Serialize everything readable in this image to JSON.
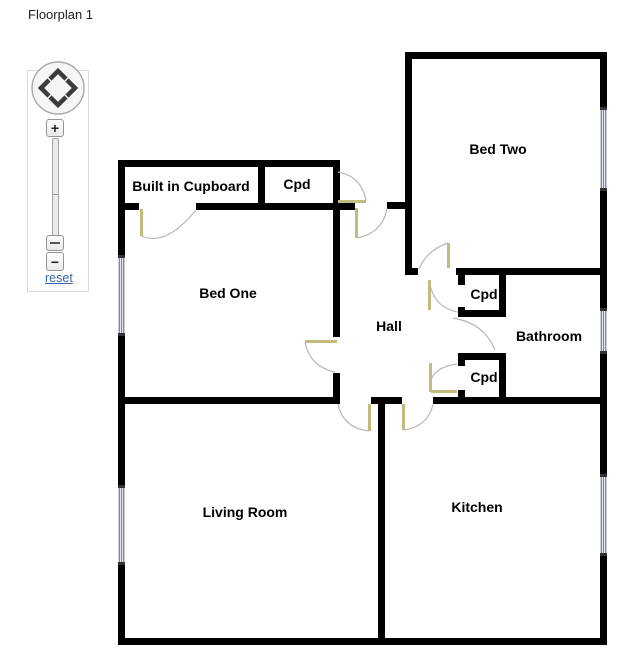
{
  "title": "Floorplan 1",
  "controls": {
    "zoom_in_label": "+",
    "zoom_out_label": "−",
    "reset_label": "reset"
  },
  "rooms": {
    "built_in_cupboard": "Built in Cupboard",
    "cpd_top": "Cpd",
    "bed_two": "Bed Two",
    "bed_one": "Bed One",
    "hall": "Hall",
    "cpd_upper": "Cpd",
    "bathroom": "Bathroom",
    "cpd_lower": "Cpd",
    "living_room": "Living Room",
    "kitchen": "Kitchen"
  },
  "colors": {
    "wall": "#000000",
    "door_leaf": "#c3ba7e",
    "door_arc": "#b8b8b8",
    "window": "#7d86b0",
    "link": "#3a66a8"
  }
}
